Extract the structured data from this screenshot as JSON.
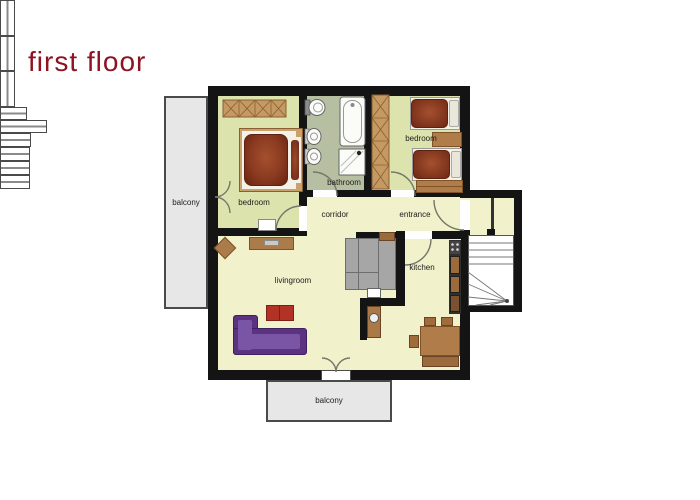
{
  "page": {
    "title": "first floor"
  },
  "rooms": [
    {
      "id": "bedroom-left",
      "label": "bedroom"
    },
    {
      "id": "bathroom",
      "label": "bathroom"
    },
    {
      "id": "bedroom-right",
      "label": "bedroom"
    },
    {
      "id": "corridor",
      "label": "corridor"
    },
    {
      "id": "entrance",
      "label": "entrance"
    },
    {
      "id": "kitchen",
      "label": "kitchen"
    },
    {
      "id": "livingroom",
      "label": "livingroom"
    },
    {
      "id": "balcony-left",
      "label": "balcony"
    },
    {
      "id": "balcony-bottom",
      "label": "balcony"
    }
  ],
  "palette": {
    "title_text": "#8e1322",
    "wall": "#141414",
    "floor_main": "#f1f1cb",
    "floor_bedroom": "#dce3ad",
    "floor_bathroom": "#b7bfa2",
    "balcony": "#e7e7e7",
    "wood": "#b07c4a",
    "wood_dark": "#7d5327",
    "bed_red": "#8a3a20",
    "sofa_purple": "#5b3380",
    "coffee_table_red": "#b23226"
  }
}
